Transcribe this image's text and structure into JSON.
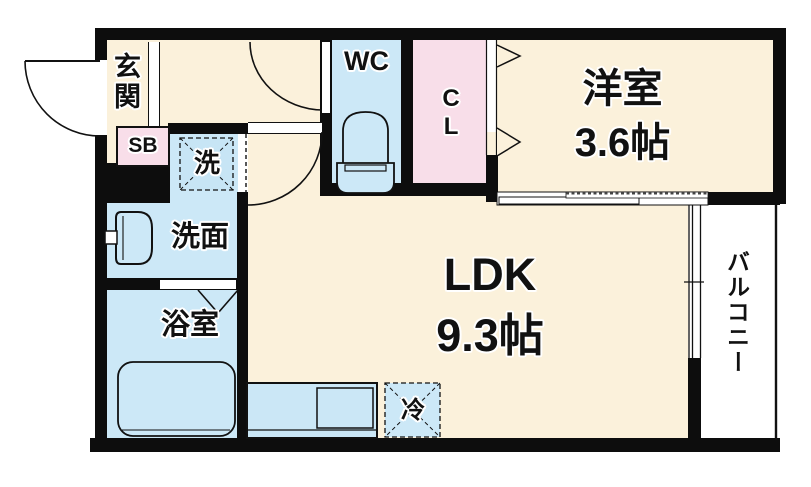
{
  "plan": {
    "type": "floor-plan",
    "rooms": {
      "genkan": {
        "label": "玄関"
      },
      "shoebox": {
        "label": "SB"
      },
      "washer_spot": {
        "label": "洗"
      },
      "toilet_room": {
        "label": "WC"
      },
      "closet": {
        "label": "CL"
      },
      "western_room": {
        "label": "洋室",
        "size": "3.6帖"
      },
      "ldk": {
        "label": "LDK",
        "size": "9.3帖"
      },
      "washroom": {
        "label": "洗面"
      },
      "bathroom": {
        "label": "浴室"
      },
      "fridge_spot": {
        "label": "冷"
      },
      "balcony": {
        "label": "バルコニー"
      }
    },
    "colors": {
      "floor_beige": "#FBF1DB",
      "wet_blue": "#CCE8F7",
      "closet_pink": "#F8DEE9",
      "wall_black": "#0D0D0D",
      "balcony_white": "#FFFFFF"
    }
  }
}
